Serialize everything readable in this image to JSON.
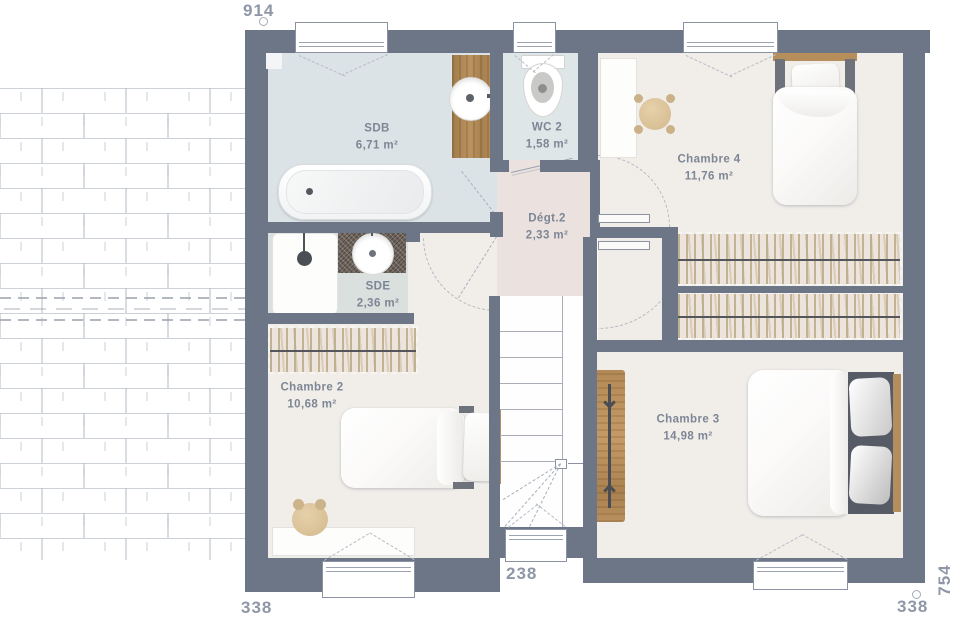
{
  "plan_title": "Floor plan - upper storey",
  "rooms": {
    "sdb": {
      "name": "SDB",
      "area": "6,71 m²"
    },
    "wc2": {
      "name": "WC 2",
      "area": "1,58 m²"
    },
    "chambre4": {
      "name": "Chambre 4",
      "area": "11,76 m²"
    },
    "degt2": {
      "name": "Dégt.2",
      "area": "2,33 m²"
    },
    "sde": {
      "name": "SDE",
      "area": "2,36 m²"
    },
    "chambre2": {
      "name": "Chambre 2",
      "area": "10,68 m²"
    },
    "chambre3": {
      "name": "Chambre 3",
      "area": "14,98 m²"
    }
  },
  "dimensions": {
    "top": "914",
    "bottom_left": "338",
    "bottom_center": "238",
    "bottom_right": "338",
    "right_vertical": "754"
  },
  "colors": {
    "wall": "#6d7687",
    "floor_bedroom": "#f1eeea",
    "floor_bath": "#dce3e6",
    "floor_hall": "#ebe2e0",
    "wood": "#b58d5a",
    "wardrobe": "#ece4dd",
    "label_text": "#7d8694",
    "dimension_text": "#8f97a6"
  },
  "furniture": [
    "bathtub",
    "vanity-sink",
    "toilet",
    "shower",
    "sde-sink",
    "single-bed-chambre4",
    "single-bed-chambre2",
    "double-bed-chambre3",
    "wardrobe-chambre4",
    "wardrobe-chambre3",
    "wardrobe-chambre2",
    "desk-chambre4",
    "desk-chambre2",
    "pouf-chambre4",
    "pouf-chambre2",
    "shelf-chambre3",
    "staircase",
    "roof-tiles"
  ]
}
